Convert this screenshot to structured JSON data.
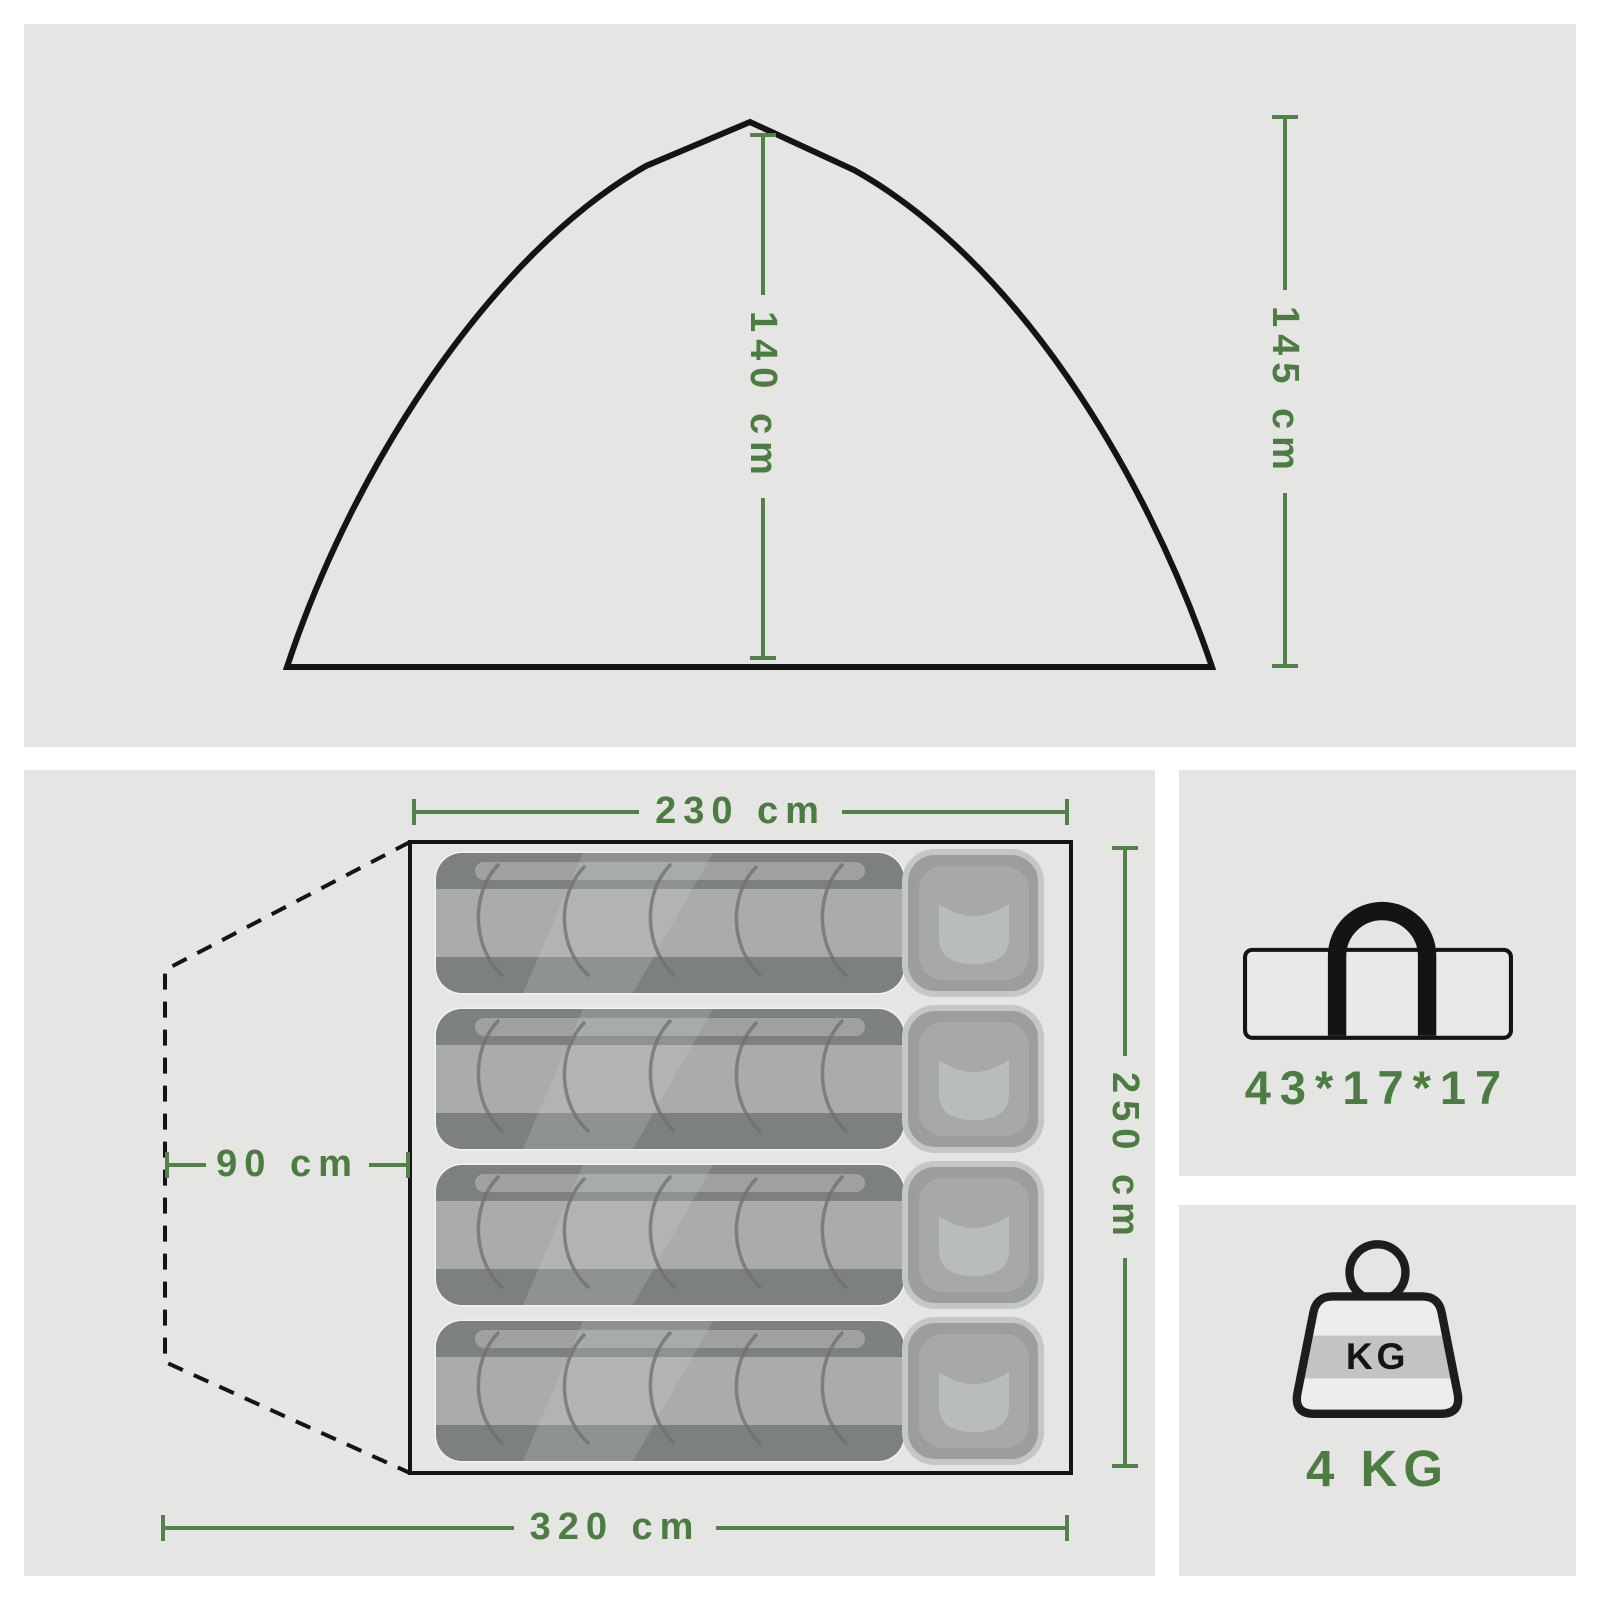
{
  "side_view": {
    "inner_height_label": "140 cm",
    "outer_height_label": "145 cm"
  },
  "floor_plan": {
    "width_label": "230 cm",
    "depth_label": "250 cm",
    "vestibule_label": "90 cm",
    "overall_width_label": "320 cm",
    "sleeping_pads": 4
  },
  "packed_bag": {
    "size_label": "43*17*17"
  },
  "weight": {
    "badge_label": "KG",
    "value_label": "4 KG"
  },
  "colors": {
    "accent_green": "#4d7c42",
    "outline_black": "#141414",
    "panel_background": "#e5e5e3",
    "pad_gray": "#919494"
  }
}
